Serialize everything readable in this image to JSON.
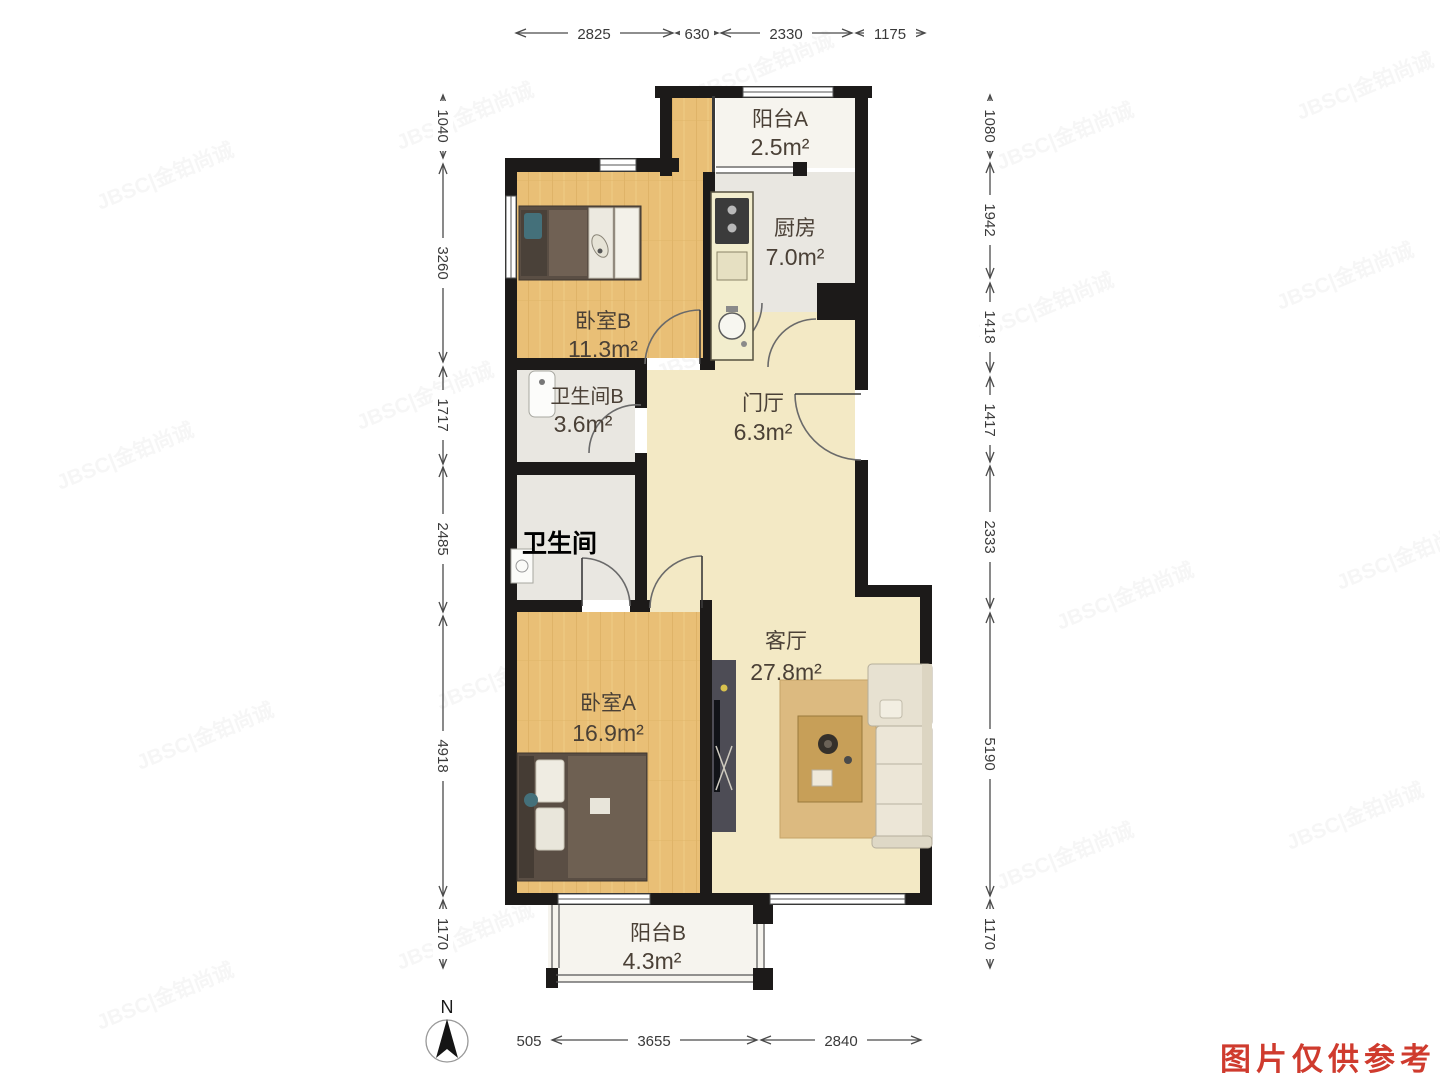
{
  "watermark": {
    "text": "JBSC|金铂尚诚"
  },
  "note": {
    "text": "图片仅供参考",
    "color": "#cf3b2e"
  },
  "compass": {
    "label": "N"
  },
  "rooms": {
    "balconyA": {
      "name": "阳台A",
      "area": "2.5m²"
    },
    "kitchen": {
      "name": "厨房",
      "area": "7.0m²"
    },
    "bedroomB": {
      "name": "卧室B",
      "area": "11.3m²"
    },
    "bathroomB": {
      "name": "卫生间B",
      "area": "3.6m²"
    },
    "foyer": {
      "name": "门厅",
      "area": "6.3m²"
    },
    "bathroom": {
      "name": "卫生间"
    },
    "living": {
      "name": "客厅",
      "area": "27.8m²"
    },
    "bedroomA": {
      "name": "卧室A",
      "area": "16.9m²"
    },
    "balconyB": {
      "name": "阳台B",
      "area": "4.3m²"
    }
  },
  "dimensions": {
    "top": [
      "2825",
      "630",
      "2330",
      "1175"
    ],
    "left": [
      "1040",
      "3260",
      "1717",
      "2485",
      "4918",
      "1170"
    ],
    "right": [
      "1080",
      "1942",
      "1418",
      "1417",
      "2333",
      "5190",
      "1170"
    ],
    "bottom": [
      "505",
      "3655",
      "2840"
    ]
  }
}
